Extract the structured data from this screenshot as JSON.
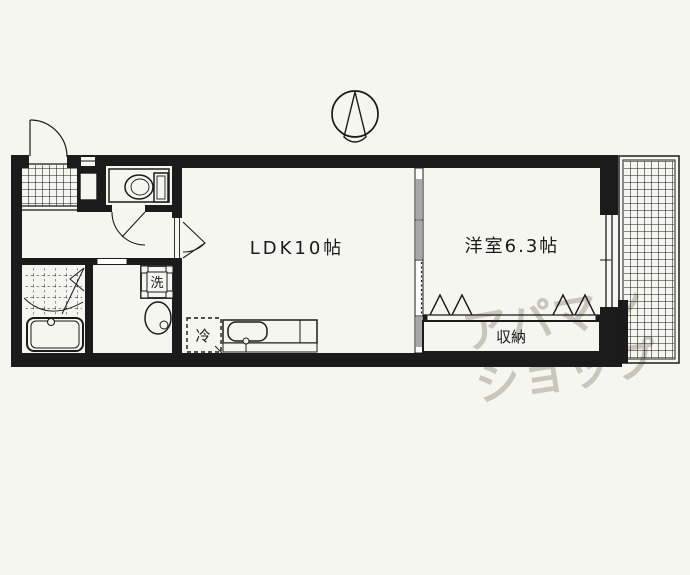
{
  "plan": {
    "compass": {
      "icon": "north-compass",
      "direction": "N"
    },
    "rooms": {
      "ldk": {
        "label": "LDK10帖"
      },
      "western": {
        "label": "洋室6.3帖"
      },
      "closet": {
        "label": "収納"
      }
    },
    "fixtures": {
      "washer": {
        "label": "洗"
      },
      "refrigerator": {
        "label": "冷"
      }
    },
    "icons": [
      "entrance-door",
      "toilet",
      "bathtub",
      "washbasin",
      "kitchen-sink",
      "balcony-grid",
      "sliding-door",
      "north-compass"
    ],
    "colors": {
      "line": "#1b1b1b",
      "background": "#f6f6f1",
      "watermark": "#c9c6bc",
      "sliding_door": "#a8a8a8"
    },
    "watermark": {
      "line1": "アパマン",
      "line2": "ショップ"
    }
  }
}
